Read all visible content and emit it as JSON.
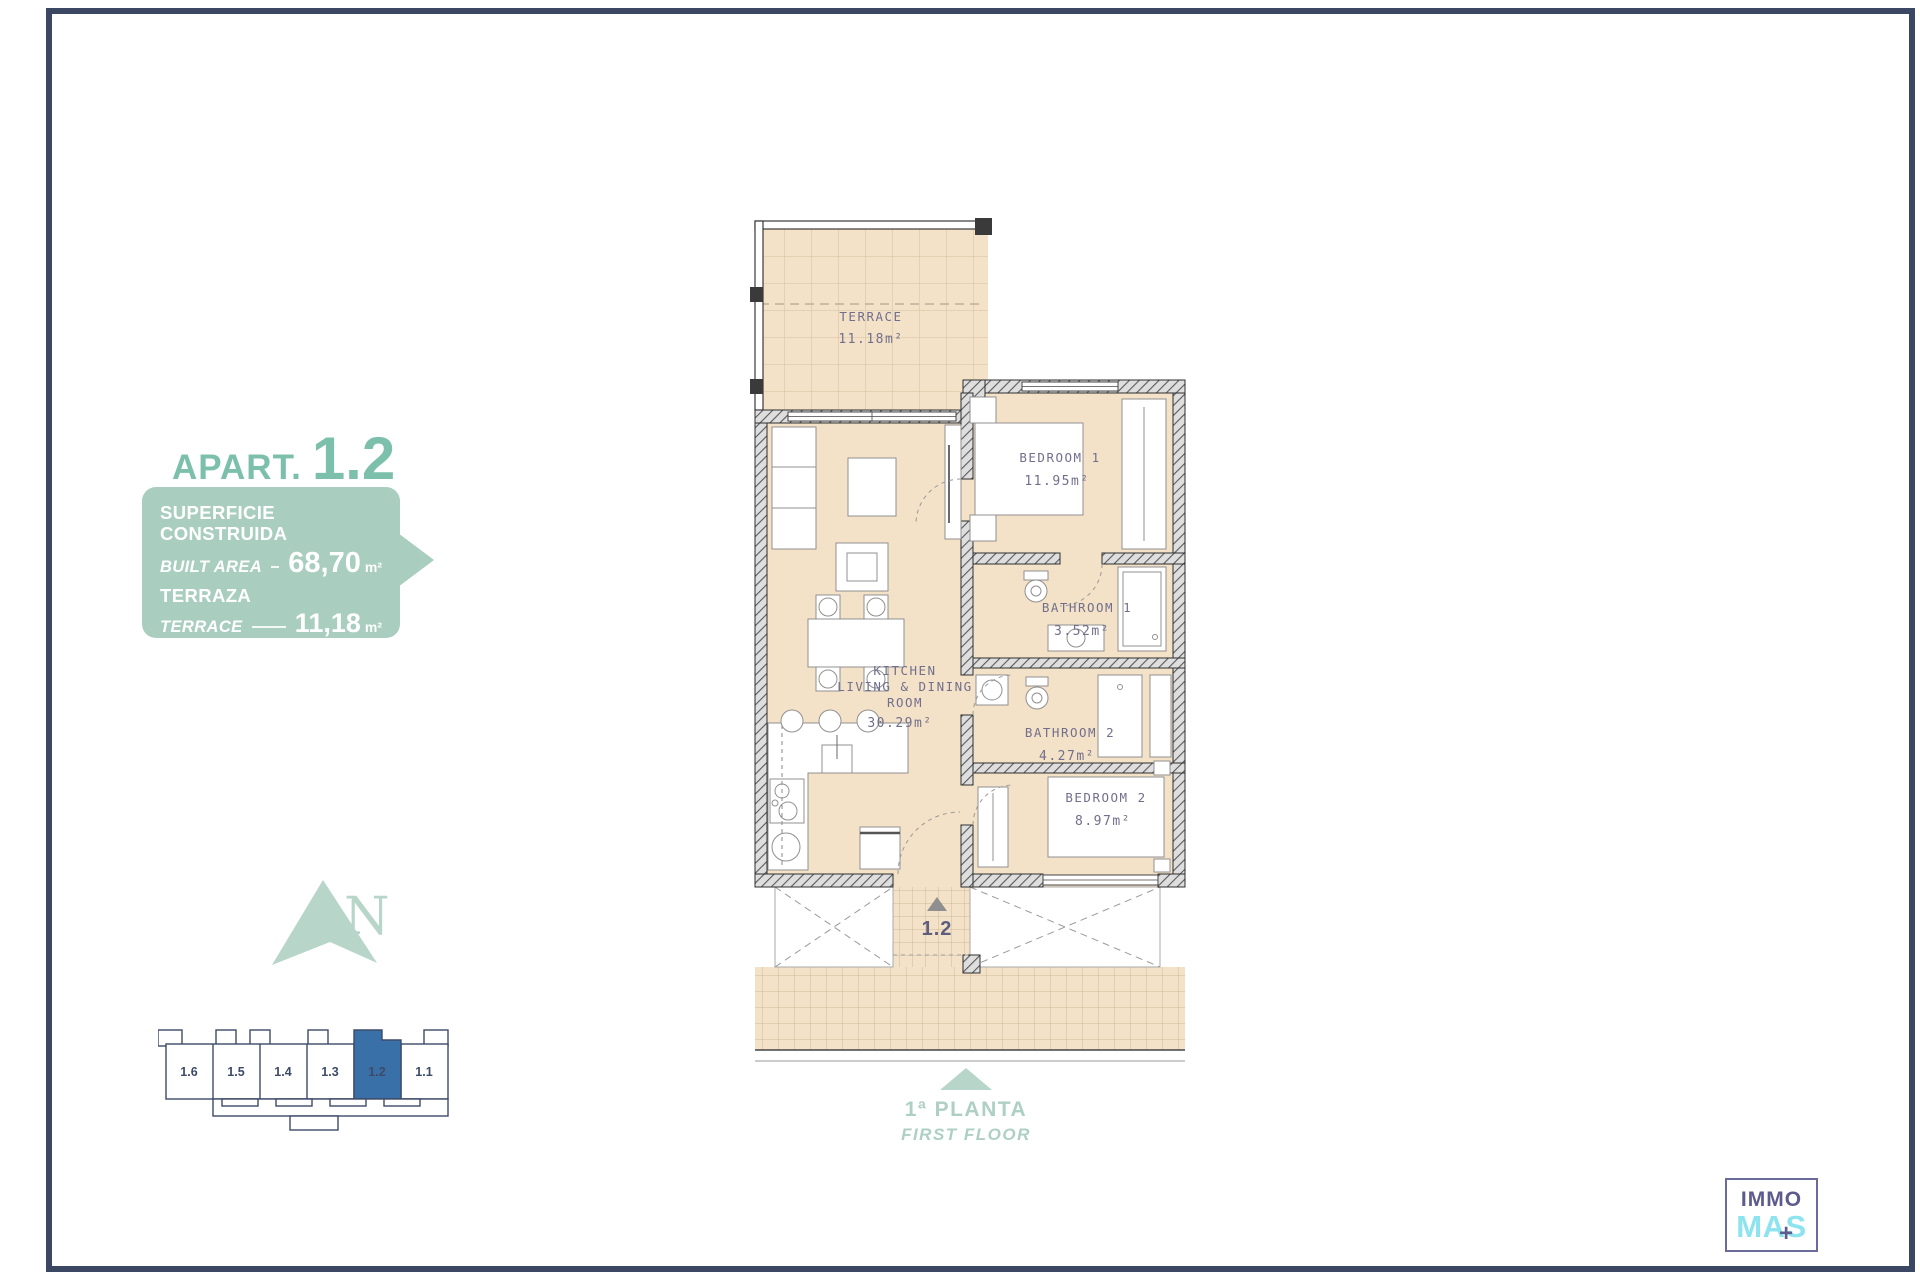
{
  "apartment": {
    "prefix": "APART.",
    "number": "1.2"
  },
  "info_box": {
    "rows": [
      {
        "label_es": "SUPERFICIE CONSTRUIDA",
        "label_en": "BUILT AREA",
        "value": "68,70",
        "unit": "m²"
      },
      {
        "label_es": "TERRAZA",
        "label_en": "TERRACE",
        "value": "11,18",
        "unit": "m²"
      }
    ],
    "total": {
      "label": "TOTAL",
      "value": "79,88",
      "unit": "m²"
    }
  },
  "compass": {
    "letter": "N"
  },
  "locator": {
    "units": [
      "1.6",
      "1.5",
      "1.4",
      "1.3",
      "1.2",
      "1.1"
    ],
    "highlighted": "1.2"
  },
  "floor_plan": {
    "rooms": {
      "terrace": {
        "name": "TERRACE",
        "area": "11.18m²"
      },
      "bedroom1": {
        "name": "BEDROOM  1",
        "area": "11.95m²"
      },
      "bathroom1": {
        "name": "BATHROOM  1",
        "area": "3.52m²"
      },
      "bathroom2": {
        "name": "BATHROOM  2",
        "area": "4.27m²"
      },
      "bedroom2": {
        "name": "BEDROOM  2",
        "area": "8.97m²"
      },
      "kitchen": {
        "line1": "KITCHEN",
        "line2": "LIVING  &  DINING",
        "line3": "ROOM",
        "area": "30.29m²"
      }
    },
    "entrance_label": "1.2"
  },
  "floor_label": {
    "es": "1ª PLANTA",
    "en": "FIRST FLOOR"
  },
  "logo": {
    "top": "IMMO",
    "bottom": "MAS",
    "plus": "+"
  },
  "colors": {
    "accent_green": "#7cc0ab",
    "box_green": "#a9cec0",
    "light_green": "#b7d5c9",
    "navy": "#3b4763",
    "highlight_blue": "#3a70a8",
    "beige": "#f3e2c8",
    "label_purple": "#716f8c",
    "logo_purple": "#5b5b8e",
    "logo_cyan": "#8de4ef"
  }
}
